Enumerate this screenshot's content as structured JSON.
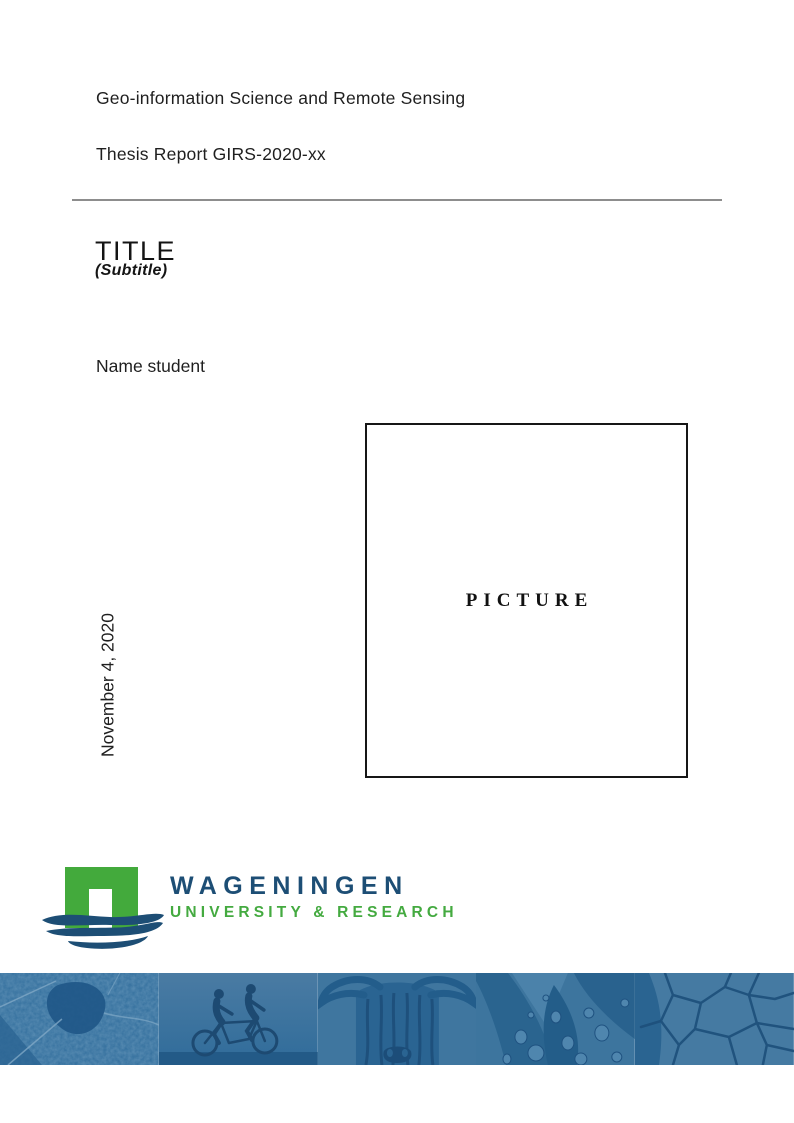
{
  "page": {
    "program": "Geo-information Science and Remote Sensing",
    "report_line": "Thesis Report GIRS-2020-xx",
    "title": "TITLE",
    "subtitle": "(Subtitle)",
    "author": "Name student",
    "date": "November 4, 2020",
    "picture_placeholder": "PICTURE"
  },
  "logo": {
    "word": "WAGENINGEN",
    "tagline": "UNIVERSITY & RESEARCH",
    "colors": {
      "blue": "#1D4E75",
      "green": "#43AA3C"
    }
  },
  "banner": {
    "tint_base": "#2E6D9B",
    "segments": [
      {
        "icon": "aerial-map-photo"
      },
      {
        "icon": "tandem-cyclists-photo"
      },
      {
        "icon": "highland-cow-photo"
      },
      {
        "icon": "water-droplets-photo"
      },
      {
        "icon": "cracked-earth-photo"
      }
    ]
  }
}
